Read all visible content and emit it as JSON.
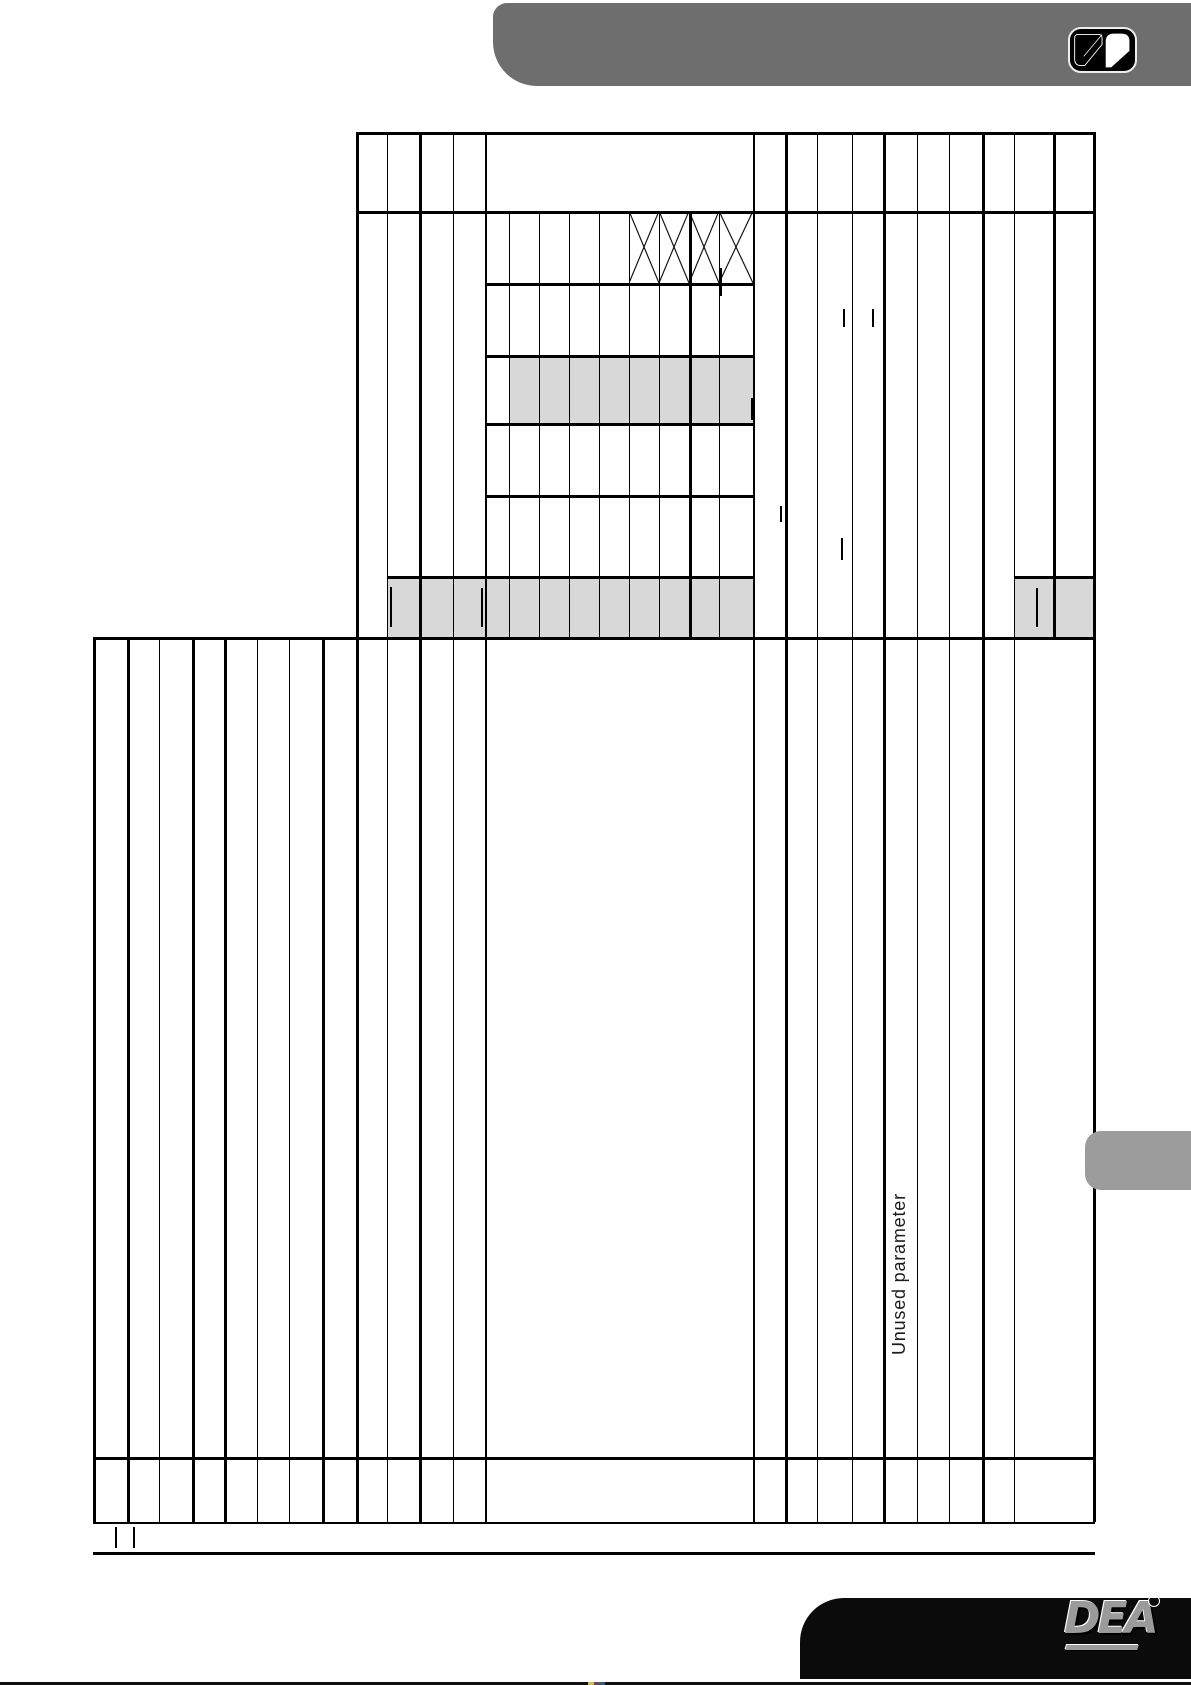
{
  "page": {
    "bg": "#ffffff",
    "rotated_label": "Unused parameter"
  },
  "header_bar": {
    "color": "#6e6e6e"
  },
  "logo_badge": {
    "icon": "open-book-icon",
    "bg": "#000000",
    "border": "#ededed"
  },
  "side_tab": {
    "color": "#9c9c9c"
  },
  "footer": {
    "bar_color": "#0b0b0b",
    "strip_color": "#101010",
    "brand": "DEA",
    "brand_mark": "°"
  },
  "table": {
    "line_color": "#000000",
    "shade_color": "#d8d8d8",
    "crossed_cells": [
      {
        "x": 629,
        "y": 211,
        "w": 30,
        "h": 72
      },
      {
        "x": 659,
        "y": 211,
        "w": 30,
        "h": 72
      },
      {
        "x": 689,
        "y": 211,
        "w": 30,
        "h": 72
      },
      {
        "x": 719,
        "y": 211,
        "w": 34,
        "h": 72
      }
    ],
    "tick_marks": [
      {
        "x": 720,
        "y": 268,
        "h": 28
      },
      {
        "x": 843,
        "y": 309,
        "h": 18
      },
      {
        "x": 872,
        "y": 309,
        "h": 18
      },
      {
        "x": 751,
        "y": 398,
        "h": 22
      },
      {
        "x": 780,
        "y": 506,
        "h": 16
      },
      {
        "x": 841,
        "y": 538,
        "h": 22
      },
      {
        "x": 390,
        "y": 587,
        "h": 40
      },
      {
        "x": 481,
        "y": 588,
        "h": 39
      },
      {
        "x": 1036,
        "y": 588,
        "h": 39
      },
      {
        "x": 115,
        "y": 1527,
        "h": 21
      },
      {
        "x": 133,
        "y": 1527,
        "h": 21
      }
    ]
  }
}
